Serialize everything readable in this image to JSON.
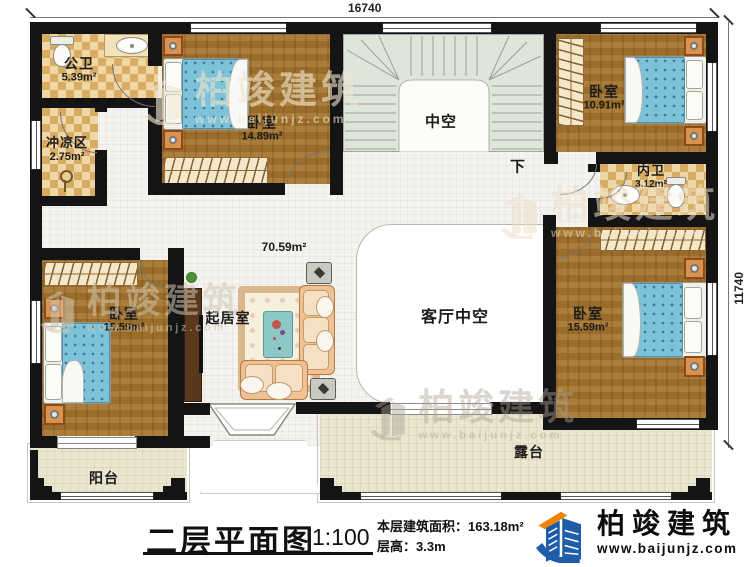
{
  "dimensions": {
    "top": "16740",
    "right": "11740"
  },
  "rooms": {
    "public_bath": {
      "name": "公卫",
      "area": "5.39m²"
    },
    "shower": {
      "name": "冲凉区",
      "area": "2.75m²"
    },
    "bedroom_top": {
      "name": "卧室",
      "area": "14.89m²"
    },
    "stair_void": {
      "name": "中空"
    },
    "stair_down": {
      "name": "下"
    },
    "bedroom_topright": {
      "name": "卧室",
      "area": "10.91m²"
    },
    "ensuite_bath": {
      "name": "内卫",
      "area": "3.12m²"
    },
    "hall_area": {
      "area": "70.59m²"
    },
    "living_room": {
      "name": "起居室"
    },
    "bedroom_left": {
      "name": "卧室",
      "area": "15.59m²"
    },
    "bedroom_right": {
      "name": "卧室",
      "area": "15.59m²"
    },
    "living_void": {
      "name": "客厅中空"
    },
    "balcony": {
      "name": "阳台"
    },
    "terrace": {
      "name": "露台"
    }
  },
  "title_block": {
    "title": "二层平面图",
    "scale": "1:100",
    "area_label": "本层建筑面积：",
    "area_value": "163.18m²",
    "height_label": "层高：",
    "height_value": "3.3m"
  },
  "brand": {
    "name": "柏竣建筑",
    "url": "www.baijunjz.com"
  },
  "colors": {
    "wall": "#141414",
    "wood": "#a0722e",
    "tile_light": "#eed7a4",
    "tile_dark": "#d9ac64",
    "bed_blue": "#7cc3da",
    "stair": "#dfe5db",
    "outdoor": "#ebe6d0",
    "logo_blue": "#1f5da9",
    "logo_orange": "#ef8200"
  }
}
